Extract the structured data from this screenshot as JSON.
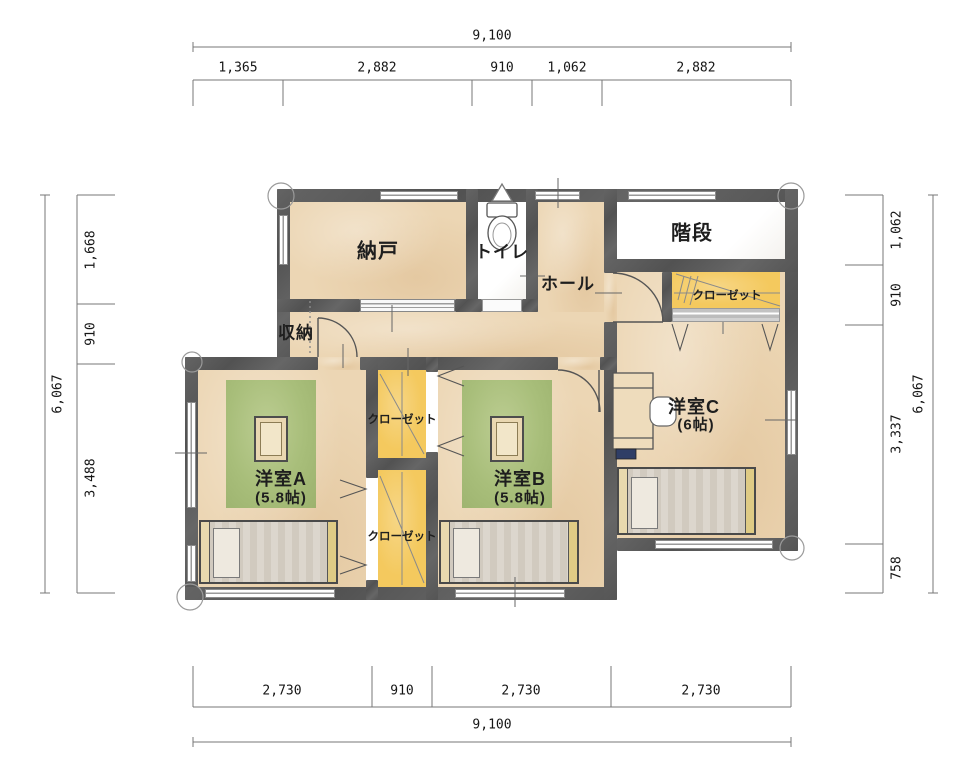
{
  "rooms": {
    "nando": {
      "label": "納戸"
    },
    "toilet": {
      "label": "トイレ"
    },
    "hall": {
      "label": "ホール"
    },
    "stairs": {
      "label": "階段"
    },
    "storage": {
      "label": "収納"
    },
    "closet_top_right": {
      "label": "クローゼット"
    },
    "closet_mid_top": {
      "label": "クローゼット"
    },
    "closet_mid_bottom": {
      "label": "クローゼット"
    },
    "room_a": {
      "label": "洋室A",
      "size": "(5.8帖)"
    },
    "room_b": {
      "label": "洋室B",
      "size": "(5.8帖)"
    },
    "room_c": {
      "label": "洋室C",
      "size": "(6帖)"
    }
  },
  "dimensions": {
    "top": {
      "total": "9,100",
      "segments": [
        "1,365",
        "2,882",
        "910",
        "1,062",
        "2,882"
      ]
    },
    "bottom": {
      "total": "9,100",
      "segments": [
        "2,730",
        "910",
        "2,730",
        "2,730"
      ]
    },
    "left": {
      "total": "6,067",
      "segments": [
        "1,668",
        "910",
        "3,488"
      ]
    },
    "right": {
      "total": "6,067",
      "segments": [
        "1,062",
        "910",
        "3,337",
        "758"
      ]
    }
  },
  "colors": {
    "wall": "#595959",
    "floor_tan": "#ecd6b4",
    "closet_yellow": "#f4c95e",
    "rug_green": "#a8be7a",
    "white_room": "#ffffff"
  }
}
